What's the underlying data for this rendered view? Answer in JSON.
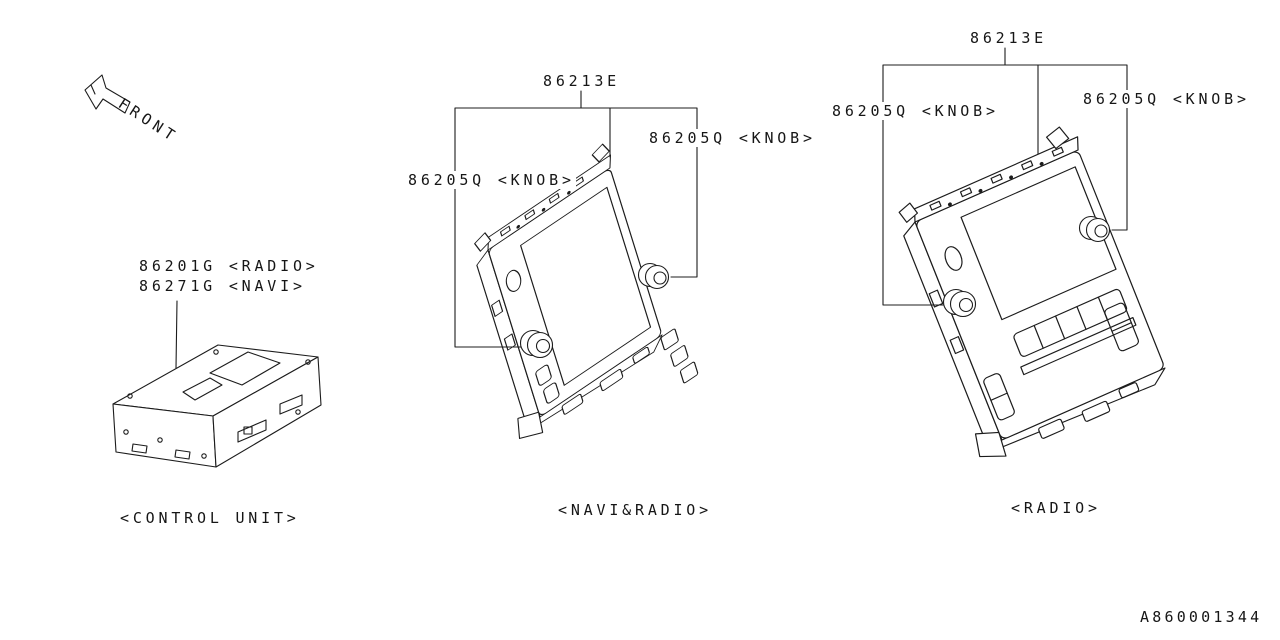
{
  "front_label": "FRONT",
  "diagram_id": "A860001344",
  "control_unit": {
    "part_radio": "86201G <RADIO>",
    "part_navi": "86271G <NAVI>",
    "caption": "<CONTROL UNIT>"
  },
  "navi_radio_unit": {
    "bracket_part": "86213E",
    "knob_left": "86205Q <KNOB>",
    "knob_right": "86205Q <KNOB>",
    "caption": "<NAVI&RADIO>"
  },
  "radio_unit": {
    "bracket_part": "86213E",
    "knob_left": "86205Q <KNOB>",
    "knob_right": "86205Q <KNOB>",
    "caption": "<RADIO>"
  },
  "colors": {
    "line": "#1c1c1c",
    "background": "#ffffff",
    "text": "#161616"
  }
}
